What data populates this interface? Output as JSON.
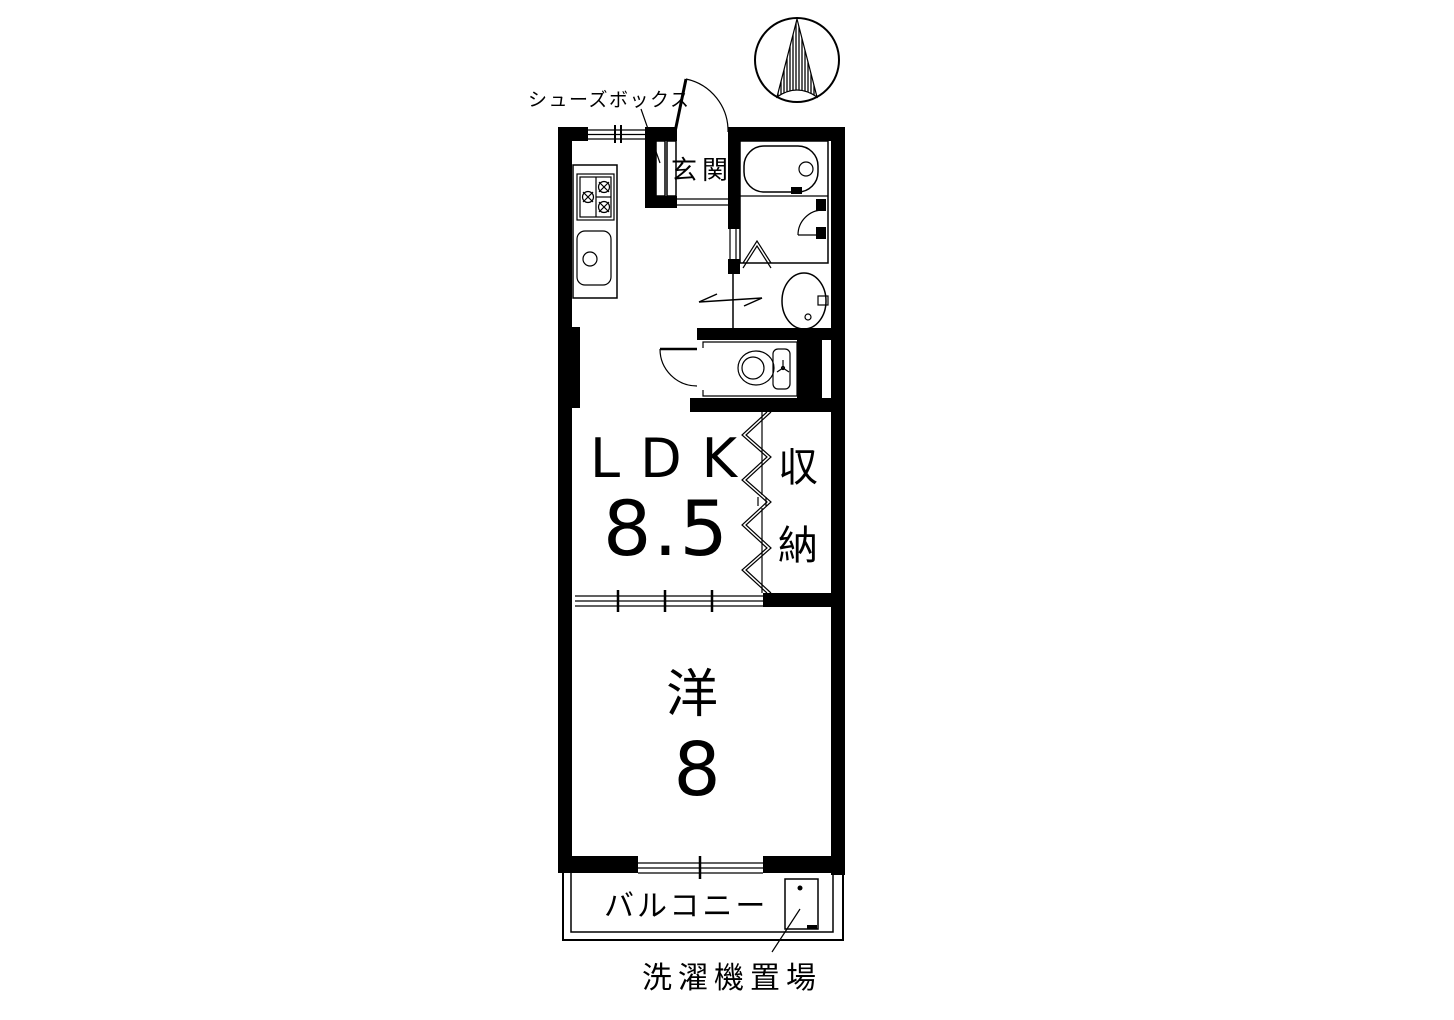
{
  "floor_plan": {
    "rooms": {
      "entrance": {
        "label": "玄関"
      },
      "ldk": {
        "label": "LDK",
        "size": "8.5"
      },
      "closet": {
        "chars": [
          "収",
          "納"
        ]
      },
      "western_room": {
        "label": "洋",
        "size": "8"
      },
      "balcony": {
        "label": "バルコニー"
      }
    },
    "annotations": {
      "shoe_box": "シューズボックス",
      "washing_machine_area": "洗濯機置場"
    },
    "icons": [
      "north-compass-icon",
      "gas-stove-icon",
      "kitchen-sink-icon",
      "bathtub-icon",
      "washbasin-icon",
      "toilet-icon",
      "washing-machine-icon",
      "entrance-door-arc",
      "toilet-door-arc",
      "shower-door-arc",
      "folding-door-icon",
      "accordion-door-icon",
      "sliding-door-arrow"
    ],
    "colors": {
      "wall": "#000000",
      "background": "#ffffff",
      "line": "#000000"
    }
  }
}
